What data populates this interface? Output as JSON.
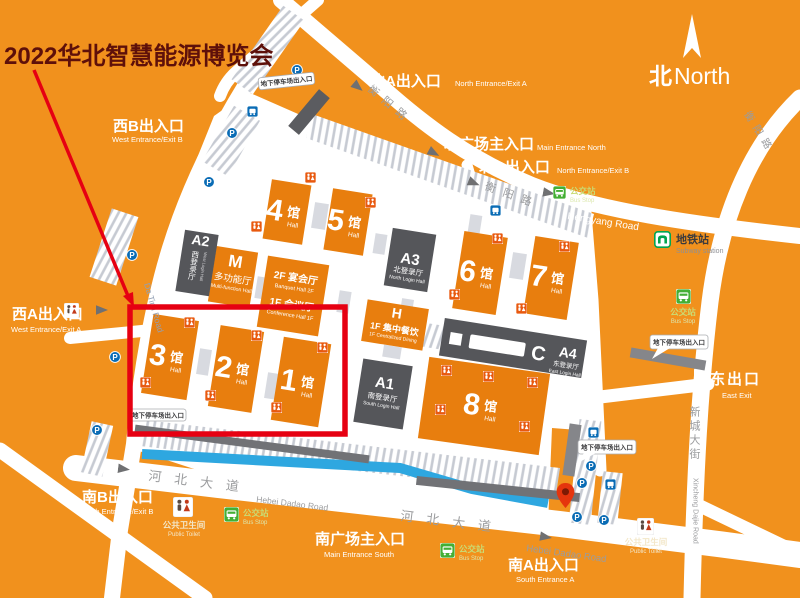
{
  "title": "2022华北智慧能源博览会",
  "compass": {
    "zh": "北",
    "en": "North"
  },
  "colors": {
    "background_orange": "#F1911D",
    "hall_orange": "#E87E0E",
    "dark_building_gray": "#55565A",
    "annotation_red": "#E60012",
    "title_dark_red": "#5E100A",
    "water_blue": "#2EA7E0",
    "subway_green": "#00A550",
    "bus_green": "#44AF35",
    "parking_blue": "#0A6CB5",
    "pin_red": "#E5350D"
  },
  "entrances": {
    "north_a": {
      "zh": "北A出入口",
      "en": "North Entrance/Exit A"
    },
    "west_b": {
      "zh": "西B出入口",
      "en": "West Entrance/Exit B"
    },
    "north_main": {
      "zh": "北广场主入口",
      "en": "Main Entrance North"
    },
    "north_b": {
      "zh": "北B出入口",
      "en": "North Entrance/Exit B"
    },
    "west_a": {
      "zh": "西A出入口",
      "en": "West Entrance/Exit A"
    },
    "east": {
      "zh": "东出口",
      "en": "East Exit"
    },
    "south_b": {
      "zh": "南B出入口",
      "en": "South Entrance/Exit B"
    },
    "south_main": {
      "zh": "南广场主入口",
      "en": "Main Entrance South"
    },
    "south_a": {
      "zh": "南A出入口",
      "en": "South Entrance A"
    }
  },
  "halls": {
    "h1": {
      "num": "1",
      "unit": "馆",
      "en": "Hall"
    },
    "h2": {
      "num": "2",
      "unit": "馆",
      "en": "Hall"
    },
    "h3": {
      "num": "3",
      "unit": "馆",
      "en": "Hall"
    },
    "h4": {
      "num": "4",
      "unit": "馆",
      "en": "Hall"
    },
    "h5": {
      "num": "5",
      "unit": "馆",
      "en": "Hall"
    },
    "h6": {
      "num": "6",
      "unit": "馆",
      "en": "Hall"
    },
    "h7": {
      "num": "7",
      "unit": "馆",
      "en": "Hall"
    },
    "h8": {
      "num": "8",
      "unit": "馆",
      "en": "Hall"
    }
  },
  "buildings": {
    "a1": {
      "code": "A1",
      "zh": "南登录厅",
      "en": "South Login Hall"
    },
    "a2": {
      "code": "A2",
      "zh": "西登录厅",
      "en": "West Login Hall"
    },
    "a3": {
      "code": "A3",
      "zh": "北登录厅",
      "en": "North Login Hall"
    },
    "a4": {
      "code": "A4",
      "zh": "东登录厅",
      "en": "East Login Hall"
    },
    "c": {
      "code": "C"
    },
    "m": {
      "code": "M",
      "zh": "多功能厅",
      "en": "Multi-function Hall"
    },
    "h": {
      "code": "H",
      "zh": "1F 集中餐饮",
      "en": "1F Centralized Dining"
    },
    "banquet": {
      "f2zh": "2F 宴会厅",
      "f2en": "Banquet Hall 2F",
      "f1zh": "1F 会议厅",
      "f1en": "Conference Hall 1F"
    }
  },
  "roads": {
    "hengyang": {
      "zh": "衡阳路",
      "en": "Hengyang Road"
    },
    "hebei": {
      "zh": "河北大道",
      "en": "Hebei Dadao Road"
    },
    "xincheng": {
      "zh": "新城大街",
      "en": "Xincheng Dajie Road"
    },
    "west": {
      "en": "Da Tinji Road"
    }
  },
  "pois": {
    "subway": {
      "zh": "地铁站",
      "en": "Subway station"
    },
    "bus": {
      "zh": "公交站",
      "en": "Bus Stop"
    },
    "toilet": {
      "zh": "公共卫生间",
      "en": "Public Toilet"
    },
    "parking_gate": {
      "zh": "地下停车场出入口"
    }
  },
  "icons": {
    "north_needle": "white kite needle",
    "subway": "green gate glyph",
    "bus_stop": "green square with white bus",
    "public_toilet": "white box with man/woman figures",
    "restroom": "orange tile with man/woman figures",
    "parking": "blue circle P",
    "bus_sign": "blue square bus",
    "map_pin": "red teardrop pin",
    "road_arrow": "gray triangle"
  }
}
